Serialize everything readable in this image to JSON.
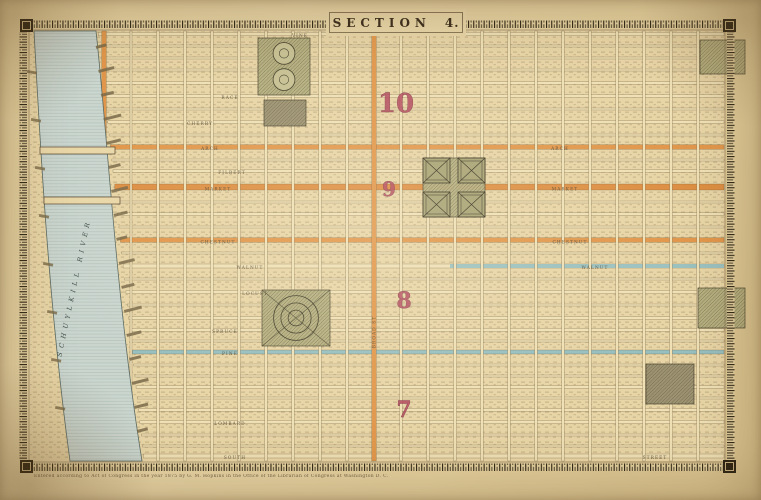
{
  "title": {
    "word": "SECTION",
    "number": "4."
  },
  "imprint": "Entered according to Act of Congress in the year 1875 by G. M. Hopkins in the Office of the Librarian of Congress at Washington D. C.",
  "map": {
    "colors": {
      "paper": "#e9d7a8",
      "block_fill": "#e8d5a6",
      "hatch_ink": "#6f5f41",
      "street_fill": "#efe0b5",
      "street_edge": "#6a5636",
      "accent_orange": "#e1974b",
      "market_orange": "#dd8f43",
      "teal_street": "#96bfc0",
      "river_fill": "#cbd6cf",
      "river_line": "#9fb0ab",
      "river_edge": "#5a6a62",
      "park_green": "#b3ad7e",
      "park_ink": "#45402a",
      "dark_block": "#9a9070",
      "wharf": "#7a6a49",
      "ruler_bg": "#e4d1a0",
      "ruler_ink": "#2b2313",
      "number_red": "#b34a5e",
      "number_red_edge": "#7c2f3f"
    },
    "frame": {
      "x0": 30,
      "y0": 31,
      "x1": 724,
      "y1": 461
    },
    "river": {
      "label": "SCHUYLKILL RIVER"
    },
    "streets_horizontal": [
      {
        "y": 34,
        "w": 3.5,
        "name": "VINE"
      },
      {
        "y": 46,
        "w": 2
      },
      {
        "y": 58,
        "w": 2
      },
      {
        "y": 70,
        "w": 2
      },
      {
        "y": 83,
        "w": 2.5
      },
      {
        "y": 96,
        "w": 3,
        "name": "RACE"
      },
      {
        "y": 109,
        "w": 2
      },
      {
        "y": 122,
        "w": 2.5,
        "name": "CHERRY"
      },
      {
        "y": 135,
        "w": 2
      },
      {
        "y": 147,
        "w": 4.5,
        "hl": "orange",
        "name": "ARCH"
      },
      {
        "y": 160,
        "w": 2
      },
      {
        "y": 171,
        "w": 2.5,
        "name": "FILBERT"
      },
      {
        "y": 187,
        "w": 6,
        "hl": "market",
        "name": "MARKET"
      },
      {
        "y": 202,
        "w": 2
      },
      {
        "y": 214,
        "w": 2.5
      },
      {
        "y": 227,
        "w": 2
      },
      {
        "y": 240,
        "w": 4.5,
        "hl": "orange",
        "name": "CHESTNUT"
      },
      {
        "y": 253,
        "w": 2,
        "name": "SANSOM"
      },
      {
        "y": 266,
        "w": 4,
        "hl": "teal",
        "hlx1": 450,
        "name": "WALNUT"
      },
      {
        "y": 279,
        "w": 2
      },
      {
        "y": 292,
        "w": 3,
        "name": "LOCUST"
      },
      {
        "y": 305,
        "w": 2
      },
      {
        "y": 318,
        "w": 2.5
      },
      {
        "y": 330,
        "w": 3,
        "name": "SPRUCE"
      },
      {
        "y": 341,
        "w": 2
      },
      {
        "y": 352,
        "w": 4,
        "hl": "teal",
        "name": "PINE"
      },
      {
        "y": 365,
        "w": 2
      },
      {
        "y": 376,
        "w": 2
      },
      {
        "y": 387,
        "w": 2.5
      },
      {
        "y": 398,
        "w": 2
      },
      {
        "y": 410,
        "w": 2.5
      },
      {
        "y": 422,
        "w": 3,
        "name": "LOMBARD"
      },
      {
        "y": 435,
        "w": 2
      },
      {
        "y": 446,
        "w": 2
      },
      {
        "y": 456,
        "w": 4,
        "name": "SOUTH"
      }
    ],
    "streets_vertical": [
      {
        "x": 104,
        "w": 4.5,
        "hl": "orange"
      },
      {
        "x": 131,
        "w": 2
      },
      {
        "x": 158,
        "w": 2.5
      },
      {
        "x": 185,
        "w": 2.5
      },
      {
        "x": 212,
        "w": 2.5
      },
      {
        "x": 239,
        "w": 2.5
      },
      {
        "x": 266,
        "w": 2.5
      },
      {
        "x": 293,
        "w": 2.5
      },
      {
        "x": 320,
        "w": 2.5
      },
      {
        "x": 347,
        "w": 2.5
      },
      {
        "x": 374,
        "w": 4.5,
        "hl": "orange",
        "name": "BROAD ST"
      },
      {
        "x": 401,
        "w": 2.5
      },
      {
        "x": 428,
        "w": 2.5
      },
      {
        "x": 455,
        "w": 2.5
      },
      {
        "x": 482,
        "w": 2.5
      },
      {
        "x": 509,
        "w": 2.5
      },
      {
        "x": 536,
        "w": 2.5
      },
      {
        "x": 563,
        "w": 2.5
      },
      {
        "x": 590,
        "w": 2.5
      },
      {
        "x": 617,
        "w": 2.5
      },
      {
        "x": 644,
        "w": 2.5
      },
      {
        "x": 671,
        "w": 2.5
      },
      {
        "x": 698,
        "w": 2.5
      }
    ],
    "parks": [
      {
        "type": "circles2",
        "x": 258,
        "y": 38,
        "w": 52,
        "h": 57,
        "name": "logan-square"
      },
      {
        "type": "dark",
        "x": 264,
        "y": 100,
        "w": 42,
        "h": 26,
        "name": "cathedral-block"
      },
      {
        "type": "quad",
        "x": 423,
        "y": 158,
        "w": 62,
        "h": 59,
        "name": "penn-square"
      },
      {
        "type": "rings",
        "x": 262,
        "y": 290,
        "w": 68,
        "h": 56,
        "name": "rittenhouse-square"
      },
      {
        "type": "hatch",
        "x": 700,
        "y": 40,
        "w": 45,
        "h": 34,
        "name": "park-northeast"
      },
      {
        "type": "hatch",
        "x": 698,
        "y": 288,
        "w": 47,
        "h": 40,
        "name": "park-east"
      },
      {
        "type": "dark",
        "x": 646,
        "y": 364,
        "w": 48,
        "h": 40,
        "name": "institution-block"
      }
    ],
    "bridges": [
      {
        "x": 40,
        "y": 147,
        "w": 75,
        "h": 7
      },
      {
        "x": 44,
        "y": 197,
        "w": 76,
        "h": 7
      }
    ],
    "district_numbers": [
      {
        "label": "10",
        "x": 396,
        "y": 112,
        "size": 26
      },
      {
        "label": "9",
        "x": 389,
        "y": 196,
        "size": 20
      },
      {
        "label": "8",
        "x": 404,
        "y": 308,
        "size": 22
      },
      {
        "label": "7",
        "x": 404,
        "y": 417,
        "size": 22
      }
    ],
    "street_labels": [
      {
        "t": "VINE",
        "x": 300,
        "y": 35.5
      },
      {
        "t": "RACE",
        "x": 230,
        "y": 97.5
      },
      {
        "t": "CHERRY",
        "x": 200,
        "y": 123.5
      },
      {
        "t": "ARCH",
        "x": 210,
        "y": 148.5
      },
      {
        "t": "ARCH",
        "x": 560,
        "y": 148.5
      },
      {
        "t": "FILBERT",
        "x": 232,
        "y": 172.5
      },
      {
        "t": "MARKET",
        "x": 218,
        "y": 189
      },
      {
        "t": "MARKET",
        "x": 565,
        "y": 189
      },
      {
        "t": "CHESTNUT",
        "x": 218,
        "y": 242
      },
      {
        "t": "CHESTNUT",
        "x": 570,
        "y": 242
      },
      {
        "t": "WALNUT",
        "x": 250,
        "y": 267.5
      },
      {
        "t": "WALNUT",
        "x": 595,
        "y": 267.5
      },
      {
        "t": "LOCUST",
        "x": 255,
        "y": 293.5
      },
      {
        "t": "SPRUCE",
        "x": 225,
        "y": 331.5
      },
      {
        "t": "PINE",
        "x": 230,
        "y": 353.5
      },
      {
        "t": "LOMBARD",
        "x": 230,
        "y": 423.5
      },
      {
        "t": "SOUTH",
        "x": 235,
        "y": 457.5
      },
      {
        "t": "STREET",
        "x": 655,
        "y": 457.5
      },
      {
        "t": "BROAD ST",
        "x": 374,
        "y": 332,
        "r": -90
      }
    ]
  }
}
